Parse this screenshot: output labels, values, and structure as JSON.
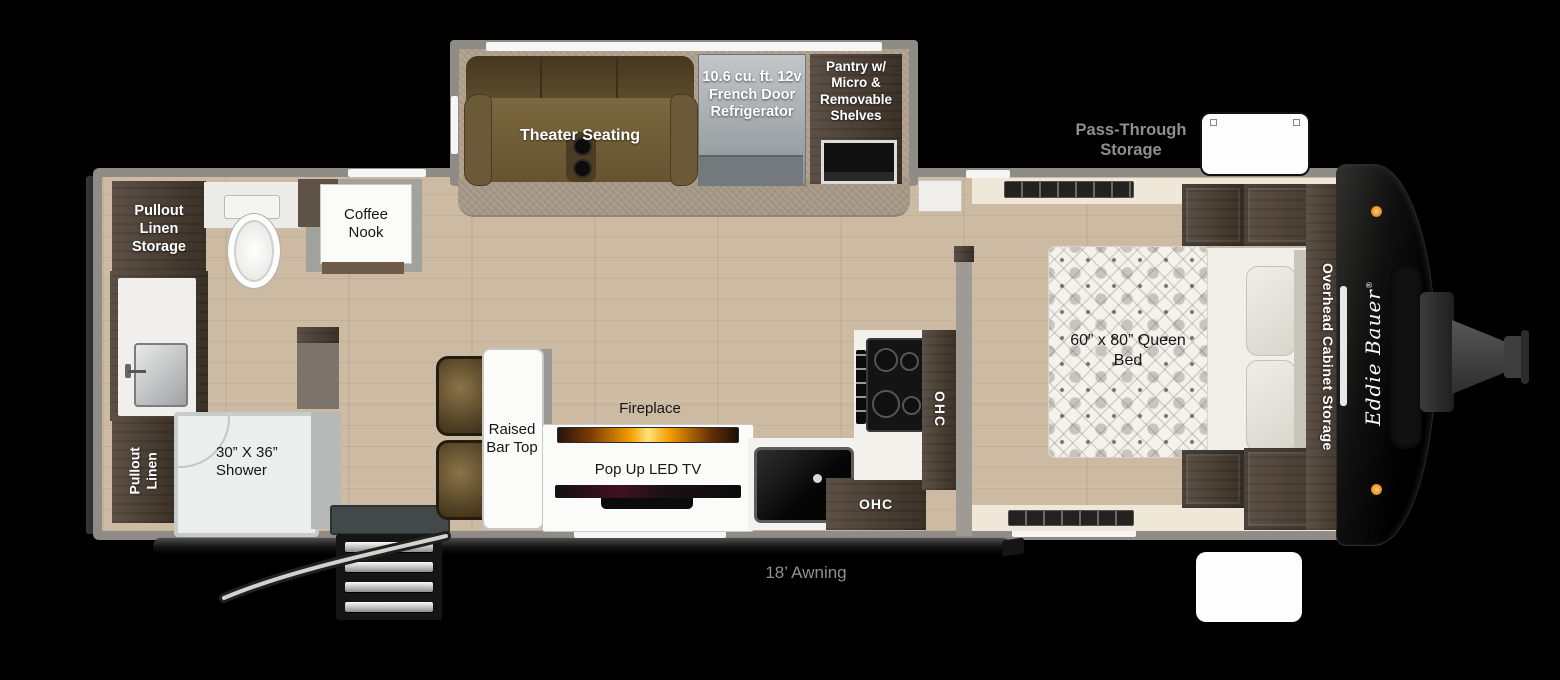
{
  "floorplan": {
    "slideout": {
      "theater_seating_label": "Theater Seating",
      "refrigerator_label": "10.6 cu. ft. 12v French Door Refrigerator",
      "pantry_label": "Pantry w/ Micro & Removable Shelves"
    },
    "bathroom": {
      "pullout_linen_storage_label": "Pullout Linen Storage",
      "pullout_linen_label": "Pullout Linen",
      "shower_label": "30” X 36” Shower"
    },
    "living_area": {
      "coffee_nook_label": "Coffee Nook",
      "raised_bar_top_label": "Raised Bar Top",
      "fireplace_label": "Fireplace",
      "tv_label": "Pop Up LED TV"
    },
    "kitchen": {
      "ohc_upper_label": "OHC",
      "ohc_lower_label": "OHC"
    },
    "bedroom": {
      "queen_bed_label": "60” x 80” Queen Bed",
      "overhead_cabinet_storage_label": "Overhead Cabinet Storage"
    },
    "exterior": {
      "pass_through_storage_label": "Pass-Through Storage",
      "awning_label": "18’ Awning",
      "brand_label": "Eddie Bauer",
      "brand_mark": "®"
    }
  },
  "colors": {
    "floor_wood": "#ccbaa2",
    "carpet": "#b1a28f",
    "rug": "#a79a88",
    "wall_gray": "#8f8c87",
    "dark_wood": "#4a3d31",
    "dark_wood_light": "#6e5b48",
    "cream": "#efe8d9",
    "white_surface": "#fbfbfa",
    "fire_glow": "#ffb312",
    "marker_light": "#e9922b",
    "label_gray": "#8f8f8f",
    "bed_quilt": "#f4f2ec"
  }
}
